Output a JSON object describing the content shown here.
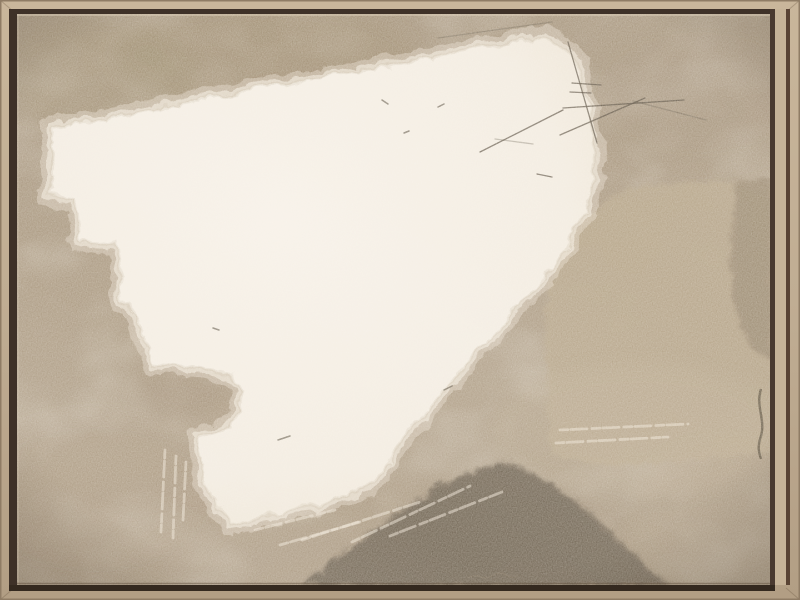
{
  "artwork": {
    "description": "Abstract painting in neutral taupe, cream and brown tones, presented in a light oak floater frame",
    "palette": {
      "frame_wood": "#c0ad93",
      "frame_wood_light": "#c9b69b",
      "frame_wood_dark": "#b29e84",
      "frame_edge": "#8f7c65",
      "frame_lip": "#c6b398",
      "groove_shadow": "#3e3128",
      "groove_right": "#4a3a30",
      "groove_bottom": "#34291f",
      "canvas_taupe": "#a8967d",
      "canvas_taupe_dark": "#94805f",
      "canvas_taupe_light": "#bcab91",
      "cream": "#f3ece1",
      "cream_deep": "#ece2d1",
      "tan_arch": "#b3a184",
      "tan_band_dark": "#95836b",
      "dark_band": "#6b5d4b",
      "scratch": "#4f4435",
      "signature": "#85755f"
    },
    "shapes": {
      "white_field": {
        "d": "M 48,125 L 300,78 L 545,33 C 562,41 574,56 581,79 C 589,106 592,140 592,168 C 590,215 555,265 500,322 C 460,362 397,438 374,477 C 351,496 290,510 228,520 C 214,505 203,485 199,468 L 195,437 C 212,432 228,422 234,410 C 239,399 240,388 233,379 C 226,370 213,367 200,365 L 150,361 L 131,311 L 127,301 L 118,298 L 115,241 L 76,237 L 73,197 L 48,194 Z"
      },
      "tan_arch": {
        "d": "M 770,185 L 720,178 L 656,182 C 611,187 577,212 560,248 C 545,281 542,320 544,360 L 549,452 C 598,467 659,463 719,456 L 770,450 Z"
      },
      "tan_right_band": {
        "d": "M 735,180 L 770,178 L 770,362 C 754,353 744,342 737,322 C 726,282 727,218 735,180 Z"
      },
      "dark_band": {
        "d": "M 300,585 C 330,558 362,534 396,511 C 431,488 470,467 500,459 C 540,471 576,498 608,530 C 633,553 652,571 667,585 Z"
      },
      "s_curve_stroke": {
        "d": "M 761,389 C 755,407 767,421 760,439 C 757,449 760,455 761,459"
      },
      "signature": {
        "d": "M 468,578 c 5,-3 9,-3 13,-1 c 4,2 8,1 12,-2 c 5,-3 11,-2 15,1 c 3,2 6,2 9,0"
      }
    },
    "scratches": [
      [
        568,
        42,
        597,
        143
      ],
      [
        572,
        83,
        601,
        85
      ],
      [
        570,
        92,
        591,
        93
      ],
      [
        563,
        108,
        684,
        100
      ],
      [
        480,
        152,
        563,
        110
      ],
      [
        560,
        135,
        645,
        98
      ],
      [
        537,
        174,
        552,
        177
      ]
    ],
    "faint_scratches": [
      [
        438,
        38,
        552,
        22
      ],
      [
        633,
        101,
        706,
        120
      ],
      [
        495,
        139,
        533,
        144
      ]
    ],
    "light_streaks": [
      [
        352,
        542,
        470,
        486
      ],
      [
        390,
        536,
        502,
        492
      ],
      [
        302,
        540,
        420,
        502
      ],
      [
        255,
        530,
        335,
        510
      ],
      [
        280,
        545,
        360,
        522
      ],
      [
        165,
        450,
        161,
        532
      ],
      [
        176,
        456,
        173,
        538
      ],
      [
        186,
        462,
        183,
        520
      ],
      [
        560,
        430,
        688,
        424
      ],
      [
        556,
        443,
        668,
        437
      ]
    ],
    "specks": [
      [
        382,
        100,
        388,
        104
      ],
      [
        438,
        107,
        444,
        104
      ],
      [
        404,
        133,
        409,
        131
      ],
      [
        213,
        328,
        219,
        330
      ],
      [
        278,
        440,
        290,
        436
      ],
      [
        444,
        390,
        452,
        386
      ]
    ]
  }
}
